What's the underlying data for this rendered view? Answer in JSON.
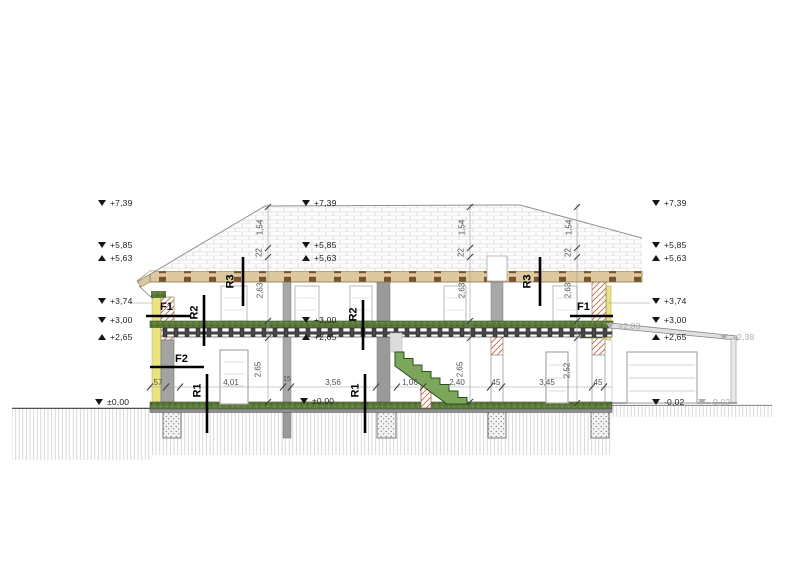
{
  "markers": {
    "left": [
      {
        "v": "+7,39",
        "dir": "down"
      },
      {
        "v": "+5,85",
        "dir": "down"
      },
      {
        "v": "+5,63",
        "dir": "up"
      },
      {
        "v": "+3,74",
        "dir": "down"
      },
      {
        "v": "+3,00",
        "dir": "down"
      },
      {
        "v": "+2,65",
        "dir": "up"
      },
      {
        "v": "±0,00",
        "dir": "down"
      }
    ],
    "center": [
      {
        "v": "+7,39",
        "dir": "down"
      },
      {
        "v": "+5,85",
        "dir": "down"
      },
      {
        "v": "+5,63",
        "dir": "up"
      },
      {
        "v": "+3,00",
        "dir": "down"
      },
      {
        "v": "+2,65",
        "dir": "up"
      },
      {
        "v": "±0,00",
        "dir": "down"
      }
    ],
    "right": [
      {
        "v": "+7,39",
        "dir": "down"
      },
      {
        "v": "+5,85",
        "dir": "down"
      },
      {
        "v": "+5,63",
        "dir": "up"
      },
      {
        "v": "+3,74",
        "dir": "down"
      },
      {
        "v": "+3,00",
        "dir": "down"
      },
      {
        "v": "+2,65",
        "dir": "up"
      },
      {
        "v": "-0,02",
        "dir": "down"
      }
    ],
    "aux": [
      {
        "v": "+2,83",
        "dir": "down",
        "shade": "gray"
      },
      {
        "v": "+2,38",
        "dir": "down",
        "shade": "gray"
      },
      {
        "v": "-0,02",
        "dir": "down",
        "shade": "gray"
      }
    ]
  },
  "labels": {
    "f1": "F1",
    "f2": "F2",
    "r1": "R1",
    "r2": "R2",
    "r3": "R3"
  },
  "dims": {
    "h": [
      "57",
      "4,01",
      "15",
      "3,56",
      "1,06",
      "2,40",
      "45",
      "3,45",
      "45"
    ],
    "roof": [
      "1,54",
      "22",
      "2,63"
    ],
    "rooms": [
      "2,65",
      "2,65",
      "2,52"
    ]
  },
  "colors": {
    "slab_green": "#5a7a39",
    "stair_green": "#7ca75a",
    "insulation_yellow": "#ebe282",
    "masonry_hatch": "#c06a48",
    "eave_tan": "#dcc9a0",
    "marker_black": "#161616",
    "marker_gray": "#adadad"
  }
}
